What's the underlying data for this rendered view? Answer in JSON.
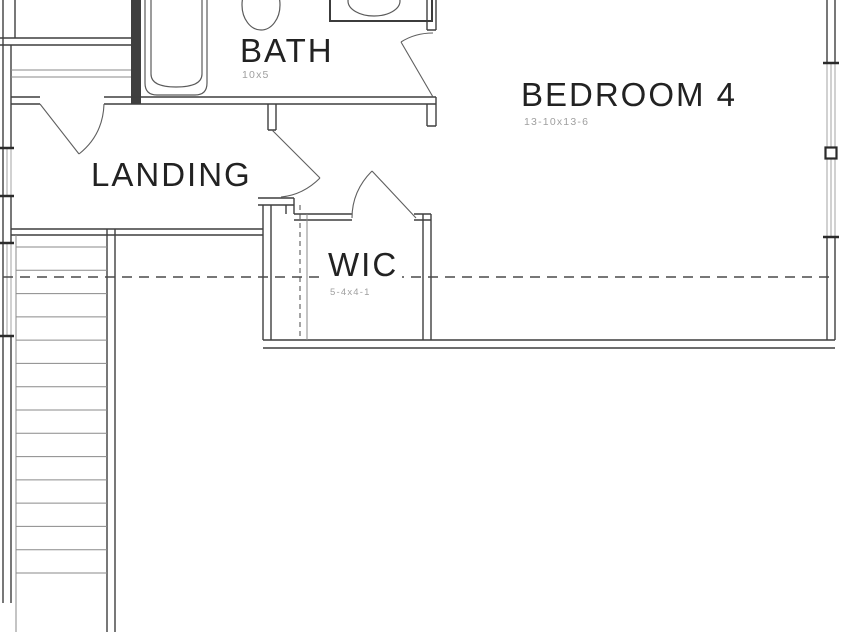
{
  "plan": {
    "type": "architectural-floor-plan",
    "rooms": [
      {
        "name": "BATH",
        "dimensions": "10x5"
      },
      {
        "name": "BEDROOM 4",
        "dimensions": "13-10x13-6"
      },
      {
        "name": "LANDING"
      },
      {
        "name": "WIC",
        "dimensions": "5-4x4-1"
      }
    ],
    "stairs": {
      "tread_count": 15
    },
    "colors": {
      "background": "#ffffff",
      "wall": "#3f3f3f",
      "wall_dark": "#2b2b2b",
      "thin": "#8a8a8a",
      "glass": "#9a9a9a",
      "fixture": "#5a5a5a",
      "door": "#5f5f5f",
      "dashed": "#4a4a4a",
      "room_text": "#222222",
      "dim_text": "#9f9f9f"
    }
  }
}
